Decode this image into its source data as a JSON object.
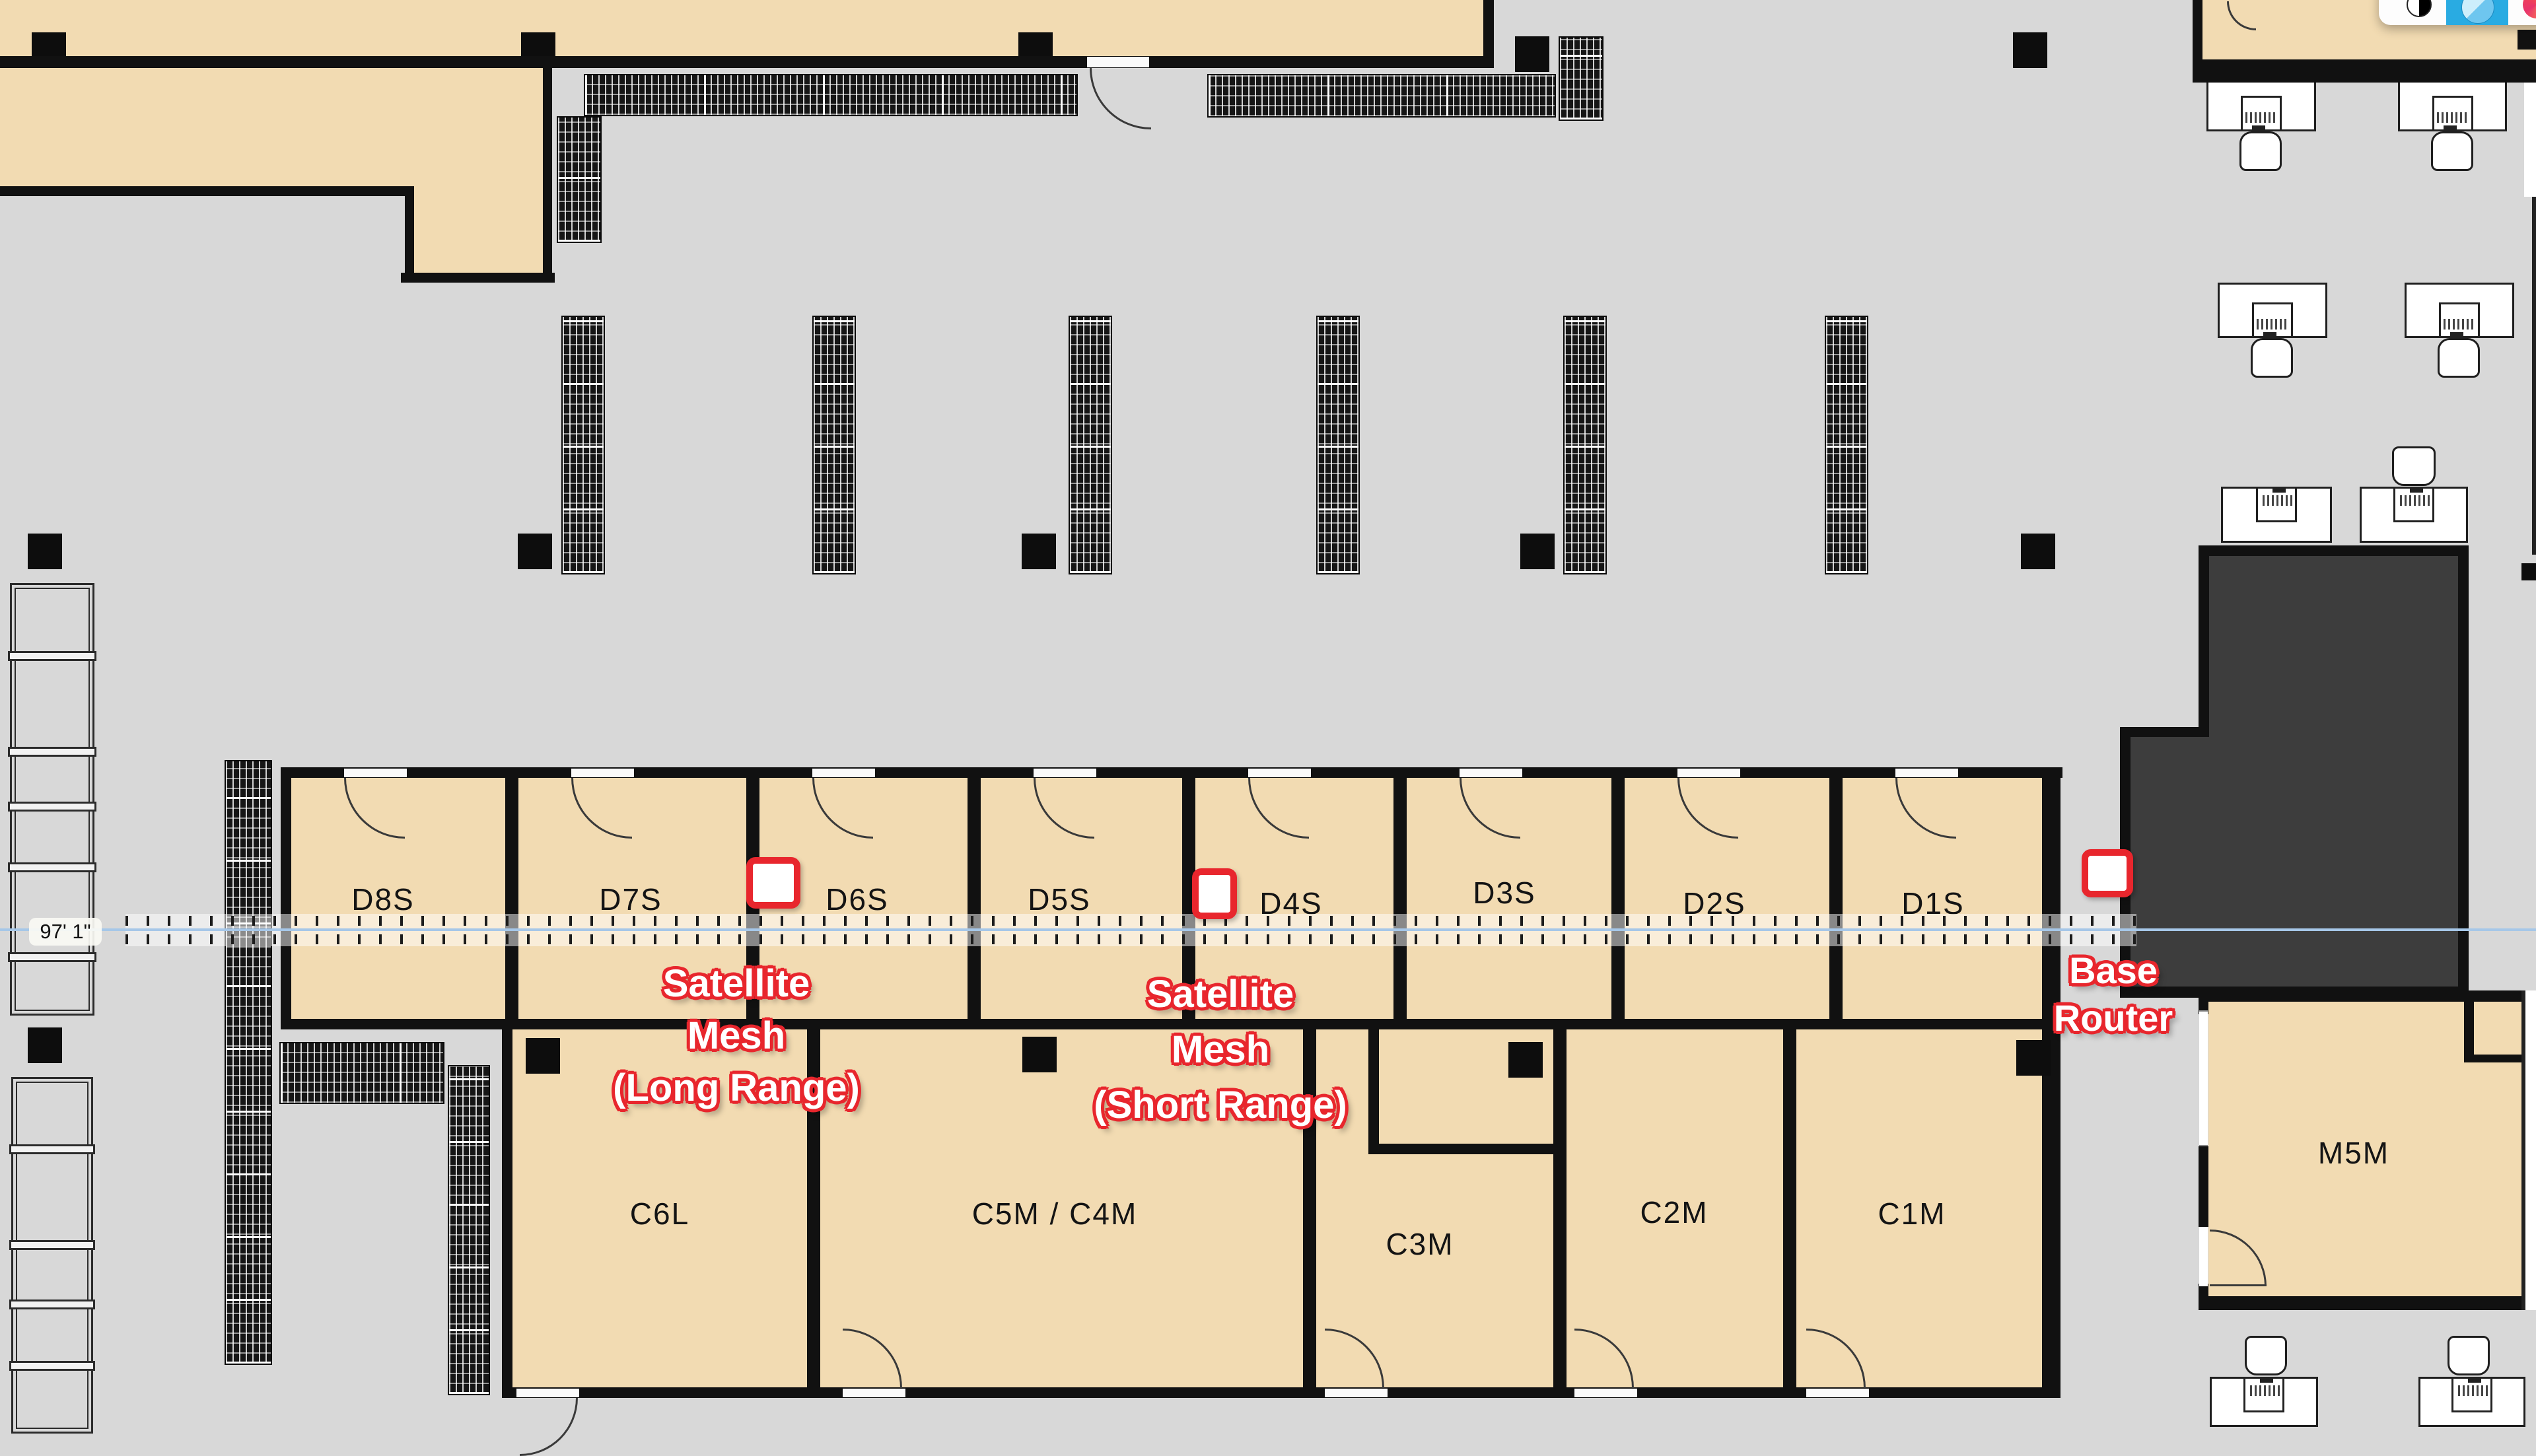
{
  "measurement": {
    "label": "97' 1\""
  },
  "rooms": {
    "d_row": [
      "D8S",
      "D7S",
      "D6S",
      "D5S",
      "D4S",
      "D3S",
      "D2S",
      "D1S"
    ],
    "c_row": [
      "C6L",
      "C5M / C4M",
      "C3M",
      "C2M",
      "C1M"
    ],
    "m5m": "M5M"
  },
  "annotations": {
    "satellite_long": [
      "Satellite",
      "Mesh",
      "(Long Range)"
    ],
    "satellite_short": [
      "Satellite",
      "Mesh",
      "(Short Range)"
    ],
    "base_router": [
      "Base",
      "Router"
    ]
  },
  "markers": {
    "long_range": "satellite-mesh-long-range",
    "short_range": "satellite-mesh-short-range",
    "base": "base-router"
  },
  "colors": {
    "accent_red": "#e8262d",
    "active_blue": "#29abe2",
    "room_fill": "#f2dbb2",
    "dark_room": "#3d3d3d",
    "dimension_blue": "#a6c7e8"
  }
}
